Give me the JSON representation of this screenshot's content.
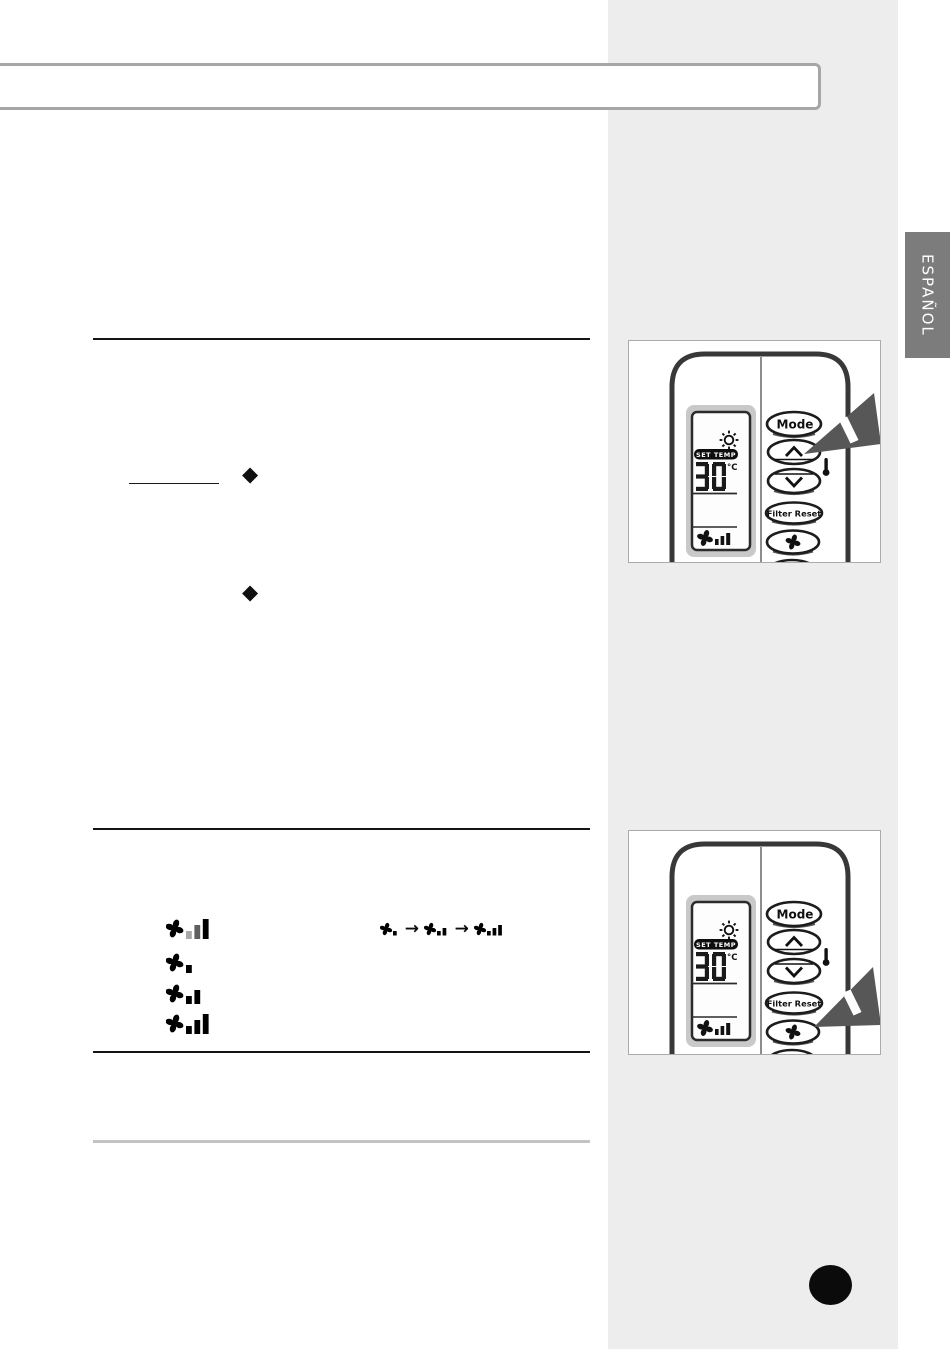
{
  "document": {
    "type": "air-conditioner remote control manual page",
    "language_tab": {
      "label": "ESPAÑOL",
      "bg_color": "#7c7c7c",
      "text_color": "#ffffff"
    },
    "sidebar_color": "#ededed",
    "bullet": "◆"
  },
  "remote": {
    "mode_label": "Mode",
    "filter_reset_label": "Filter Reset",
    "lcd": {
      "set_temp_label": "SET TEMP",
      "temperature": "30",
      "unit": "°C"
    },
    "bottom_button_glyph": "|>"
  },
  "figures": [
    {
      "name": "press-temp-up-figure",
      "arrow_target": "temp-up-button"
    },
    {
      "name": "press-fan-speed-figure",
      "arrow_target": "fan-speed-button"
    }
  ],
  "fan_section": {
    "rows": [
      {
        "name": "fan-speed-indicator-animated",
        "bars": [
          {
            "level": 1,
            "color": "#a8a8a8"
          },
          {
            "level": 2,
            "color": "#5f5f5f"
          },
          {
            "level": 3,
            "color": "#000000"
          }
        ]
      },
      {
        "name": "fan-speed-low",
        "bars": [
          {
            "level": 1,
            "color": "#000000"
          }
        ]
      },
      {
        "name": "fan-speed-medium",
        "bars": [
          {
            "level": 1,
            "color": "#000000"
          },
          {
            "level": 2,
            "color": "#000000"
          }
        ]
      },
      {
        "name": "fan-speed-high",
        "bars": [
          {
            "level": 1,
            "color": "#000000"
          },
          {
            "level": 2,
            "color": "#000000"
          },
          {
            "level": 3,
            "color": "#000000"
          }
        ]
      }
    ],
    "sequence": {
      "items": [
        {
          "bars": 1
        },
        {
          "bars": 2
        },
        {
          "bars": 3
        }
      ],
      "arrow": "→"
    }
  },
  "icons": {
    "fan": "four-blade-fan",
    "sun": "sun-with-rays",
    "thermometer": "thermometer",
    "chevron_up": "∧",
    "chevron_down": "∨",
    "press_pointer": "tapered-press-arrow",
    "bullet": "◆",
    "arrow_right": "→"
  },
  "colors": {
    "accent_dark": "#141414",
    "pointer_gray": "#575757",
    "rule_gray": "#c3c3c3",
    "band_border": "#a6a6a6"
  }
}
